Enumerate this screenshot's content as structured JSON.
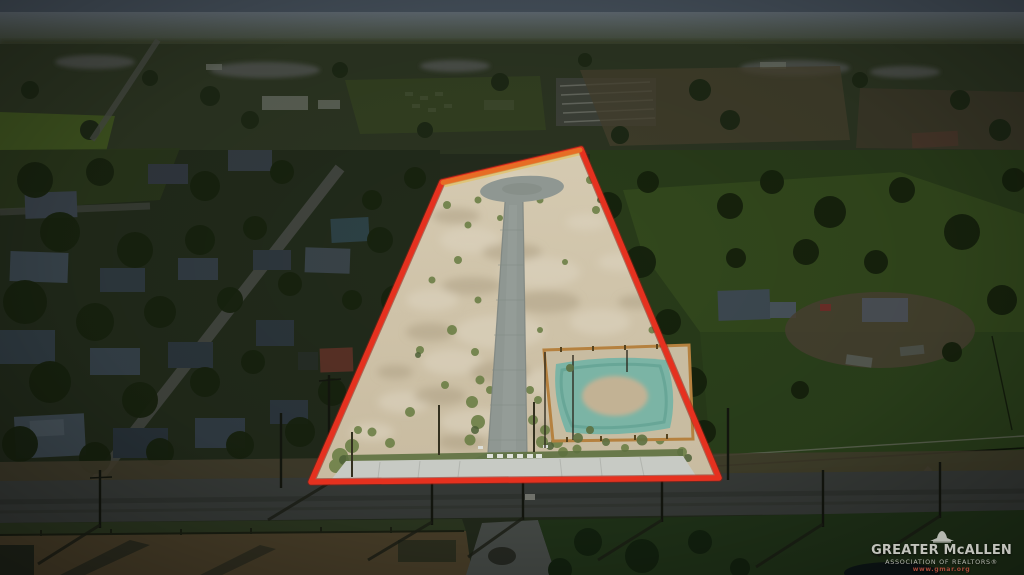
{
  "image": {
    "kind": "aerial-drone-listing-photo"
  },
  "watermark": {
    "org": "GREATER McALLEN",
    "subtitle": "ASSOCIATION OF REALTORS®",
    "website": "www.gmar.org"
  },
  "colors": {
    "sky": "#46515c",
    "outline_red": "#e5311f",
    "outline_orange": "#e87426",
    "dirt_tan": "#cbbfa5",
    "asphalt_new": "#8f9792",
    "concrete": "#c7cac4",
    "basin_teal": "#77b3a5",
    "fence_orange": "#b5813f"
  }
}
